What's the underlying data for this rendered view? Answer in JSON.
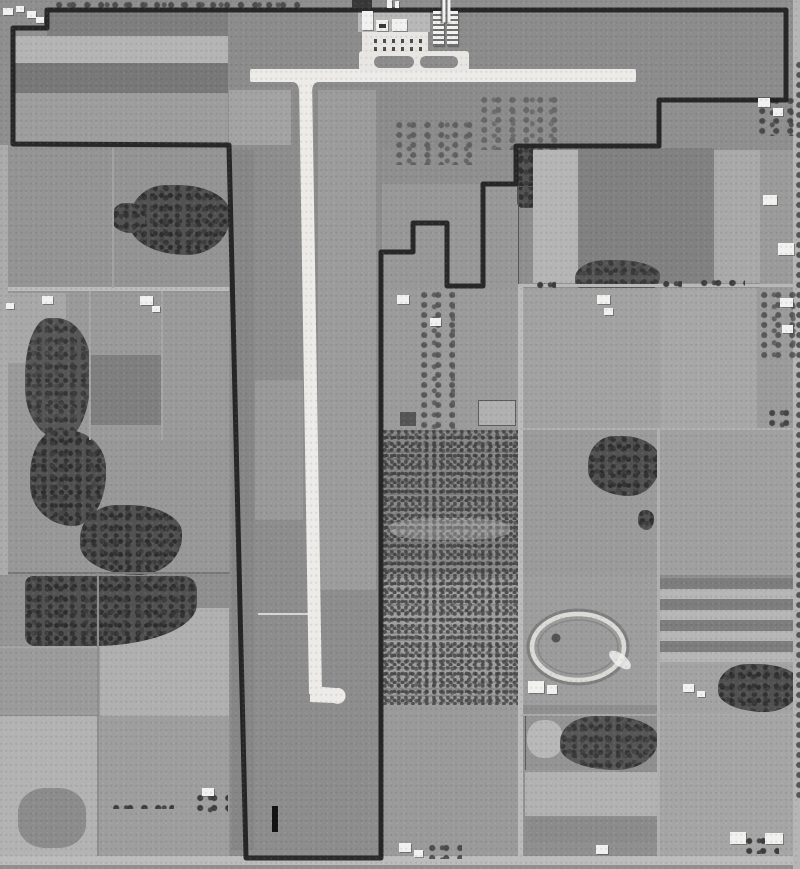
{
  "image": {
    "kind": "black-and-white aerial survey photograph",
    "subject": "small airport with T-shaped turf/paved runway layout surrounded by farmland parcels, property boundary inked in black",
    "width_px": 800,
    "height_px": 869
  },
  "palette": {
    "base": "#8f8f8f",
    "turf": "#8c8c8c",
    "boundary": "#1e1e1e",
    "runway": "#ecebe7",
    "apron": "#e7e6e2",
    "road": "#bcbcbc",
    "woods": "#525252",
    "track_ring": "#dcdbd8",
    "bldg_white": "#f1f1ef",
    "bldg_dark": "#383838",
    "tick": "#121212"
  },
  "features": {
    "boundary": "airport property boundary (inked outline)",
    "runway_ns": "north-south runway with turnaround hook at south end",
    "runway_ew": "east-west runway",
    "apron": "aircraft parking apron with ground markings",
    "hangars": "hangar rows and airport buildings",
    "racetrack": "oval racetrack with infield",
    "strip_field": "strip-cropped field (alternating light and dark bands)",
    "woodlot": "woodlot / tree cover",
    "scrubland": "brushy scrub parcel",
    "farmstead": "farmstead buildings",
    "road": "section road",
    "tick_mark": "black surveyor ink tick mark",
    "strips_top": "strip-cropped bands inside northwest parcel"
  }
}
